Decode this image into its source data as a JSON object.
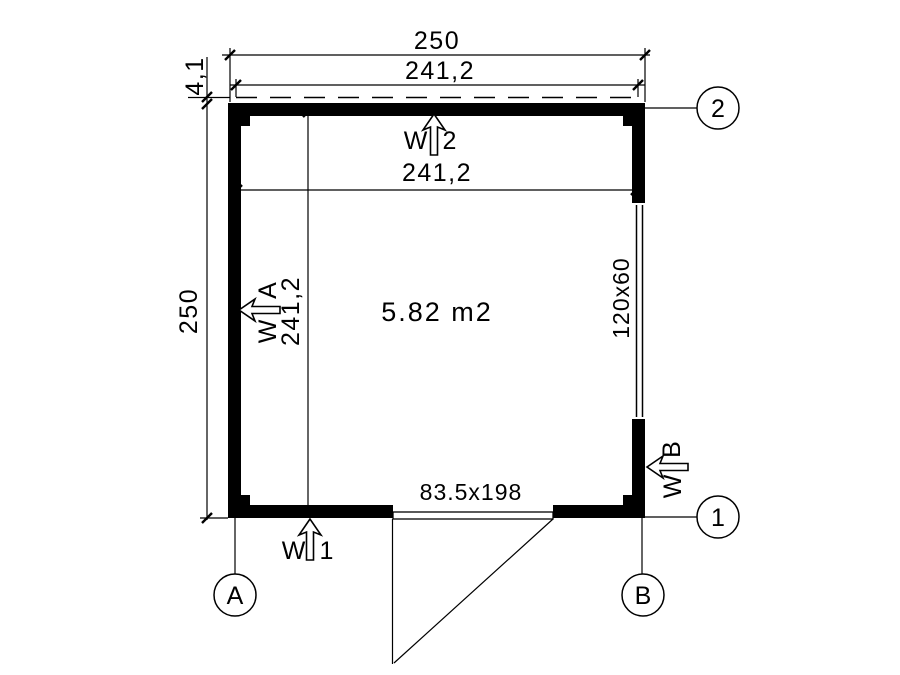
{
  "plan": {
    "area_label": "5.82 m2",
    "dims": {
      "overall_width": "250",
      "overall_height": "250",
      "interior_width_top": "241,2",
      "interior_width_inner": "241,2",
      "interior_height_inner": "241,2",
      "roof_overhang": "4,1"
    },
    "openings": {
      "window_label": "120x60",
      "door_label": "83.5x198"
    },
    "wall_marks": {
      "w1": {
        "prefix": "W",
        "num": "1"
      },
      "w2": {
        "prefix": "W",
        "num": "2"
      },
      "wa": {
        "prefix": "W",
        "num": "A"
      },
      "wb": {
        "prefix": "W",
        "num": "B"
      }
    },
    "grid_axes": {
      "two": "2",
      "one": "1",
      "a": "A",
      "b": "B"
    },
    "colors": {
      "line": "#000000",
      "wall_fill": "#000000",
      "background": "#ffffff"
    }
  }
}
